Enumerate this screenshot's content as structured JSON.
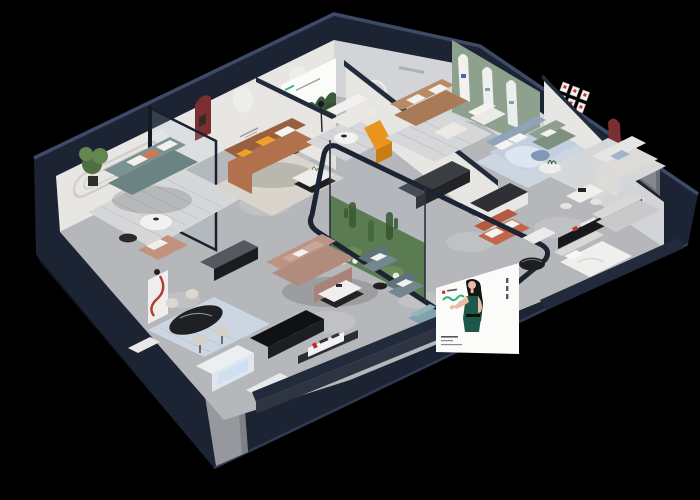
{
  "scene": {
    "title": "isometric-furniture-showroom-render",
    "background": "#000000",
    "view": "cutaway isometric floor plan of a furniture showroom at night"
  },
  "signs": {
    "wall_logo": "LUVLU"
  },
  "billboard": {
    "figure": "woman-in-green-dress",
    "panel_color": "#fbfbfa",
    "logo_color": "#2fae84"
  },
  "colors": {
    "navy": "#1c2434",
    "base": "#121824",
    "navyCap": "#222b3c",
    "navyEdge": "#3d4a68",
    "floor": "#b6b7ba",
    "floorLight": "#c9cacc",
    "wall": "#e7e6e3",
    "wallShade": "#d3d4d7",
    "wallGray": "#c0c1c5",
    "sage": "#8ea18e",
    "caramel": "#b0714c",
    "caramelDark": "#9a5f3e",
    "teal": "#6b8483",
    "brown": "#a87a58",
    "mauve": "#b08b7e",
    "mauveLight": "#c9a797",
    "blueGray": "#74878f",
    "bedBlue": "#c3cfde",
    "duvet": "#dde5f0",
    "orange": "#e8941f",
    "redNiche": "#7c2f33",
    "redAccent": "#c03a30",
    "green1": "#4e6f42",
    "green2": "#64864f",
    "terrarium": "#5b7b53",
    "billboardGreen": "#2fae84",
    "dressGreen": "#1c594a",
    "skin": "#e9bba6",
    "white": "#f0efed",
    "black": "#1b1c1f",
    "cream": "#ded9cf",
    "rug": "#d6d7d9",
    "rugBlue": "#ccd6e2",
    "rugBeige": "#d9d5cc",
    "greenSofa": "#7e9181",
    "lightSofa": "#dcdbd8",
    "terracotta": "#c1664a",
    "glass": "#a9c0cb"
  },
  "rooms": [
    {
      "id": "lounge-teal",
      "furniture": [
        "teal-sofa",
        "striped-rug",
        "round-coffee-table",
        "black-side-table",
        "potted-plant",
        "wall-moulding",
        "tan-chaise"
      ]
    },
    {
      "id": "living-caramel",
      "furniture": [
        "caramel-leather-sofa",
        "yellow-pillow",
        "coffee-table",
        "red-arch-niche",
        "beige-rug",
        "glass-partition"
      ]
    },
    {
      "id": "poster-room",
      "furniture": [
        "forest-poster",
        "white-sofa",
        "round-table",
        "floor-lamp",
        "orange-lounge-chair"
      ]
    },
    {
      "id": "living-brown",
      "furniture": [
        "brown-sofa",
        "ring-light",
        "striped-rug",
        "coffee-table"
      ]
    },
    {
      "id": "arch-wall-room",
      "furniture": [
        "sage-arch-wall",
        "white-armchair",
        "blue-bed",
        "blue-rug"
      ]
    },
    {
      "id": "gallery-bedroom",
      "furniture": [
        "picture-frame-grid",
        "red-arch-niche",
        "green-sofa",
        "round-table",
        "light-sectional",
        "dining-set",
        "window"
      ]
    },
    {
      "id": "front-right-room",
      "furniture": [
        "brand-signboard",
        "gray-sofa",
        "white-bed",
        "black-round-table",
        "white-ottoman"
      ]
    },
    {
      "id": "kitchen-display",
      "furniture": [
        "black-counter",
        "white-island",
        "terracotta-sofa",
        "wall-logo"
      ]
    },
    {
      "id": "center-lounge",
      "furniture": [
        "mauve-sectional",
        "coffee-table",
        "blue-gray-armchair",
        "blue-gray-armchair",
        "black-side-table",
        "teal-ottoman"
      ]
    },
    {
      "id": "dining-display",
      "furniture": [
        "black-oval-table",
        "cream-chairs",
        "red-curve-shelf",
        "black-console",
        "blue-rug",
        "display-bench",
        "lit-display-cabinet",
        "white-bench"
      ]
    },
    {
      "id": "terrarium",
      "furniture": [
        "glass-enclosure",
        "navy-rail",
        "cacti",
        "moss",
        "white-flowers"
      ]
    }
  ]
}
